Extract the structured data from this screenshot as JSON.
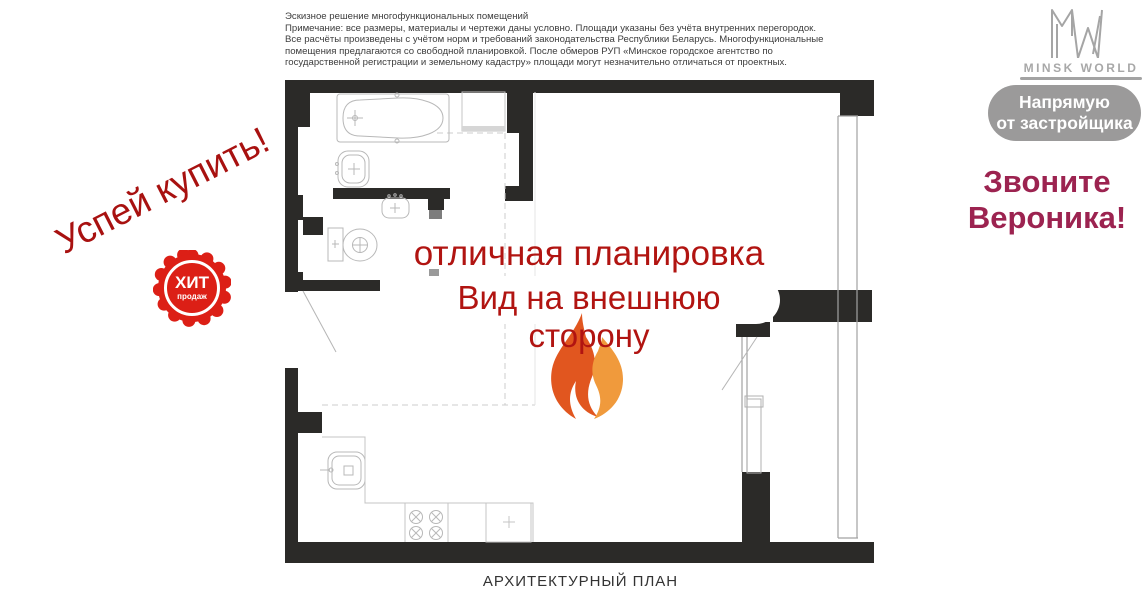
{
  "colors": {
    "wall": "#2b2a28",
    "fixture_line": "#b8b8b8",
    "promo_red": "#b11411",
    "hurry_red": "#a81110",
    "hit_badge_red": "#dc1f16",
    "call_pink": "#9c2350",
    "badge_gray": "#9b9a9a",
    "logo_gray": "#a8a8a8",
    "flame_dark": "#e1561f",
    "flame_light": "#f09a3c"
  },
  "disclaimer": {
    "lines": [
      "Эскизное решение многофункциональных помещений",
      "Примечание: все размеры, материалы и чертежи даны условно. Площади указаны без учёта внутренних перегородок.",
      "Все расчёты произведены с учётом норм и требований законодательства Республики Беларусь. Многофункциональные",
      "помещения предлагаются со свободной планировкой. После обмеров РУП «Минское городское агентство по",
      "государственной регистрации и земельному кадастру» площади могут незначительно отличаться от проектных."
    ]
  },
  "promo": {
    "hurry_text": "Успей купить!",
    "hit_badge": {
      "line1": "ХИТ",
      "line2": "продаж"
    },
    "headline1": "отличная планировка",
    "headline2": "Вид на внешнюю сторону"
  },
  "brand": {
    "logo_monogram": "MW",
    "logo_name": "MINSK WORLD",
    "direct_badge": {
      "line1": "Напрямую",
      "line2": "от застройщика"
    },
    "call": {
      "line1": "Звоните",
      "line2": "Вероника!"
    }
  },
  "plan": {
    "caption": "АРХИТЕКТУРНЫЙ ПЛАН"
  }
}
